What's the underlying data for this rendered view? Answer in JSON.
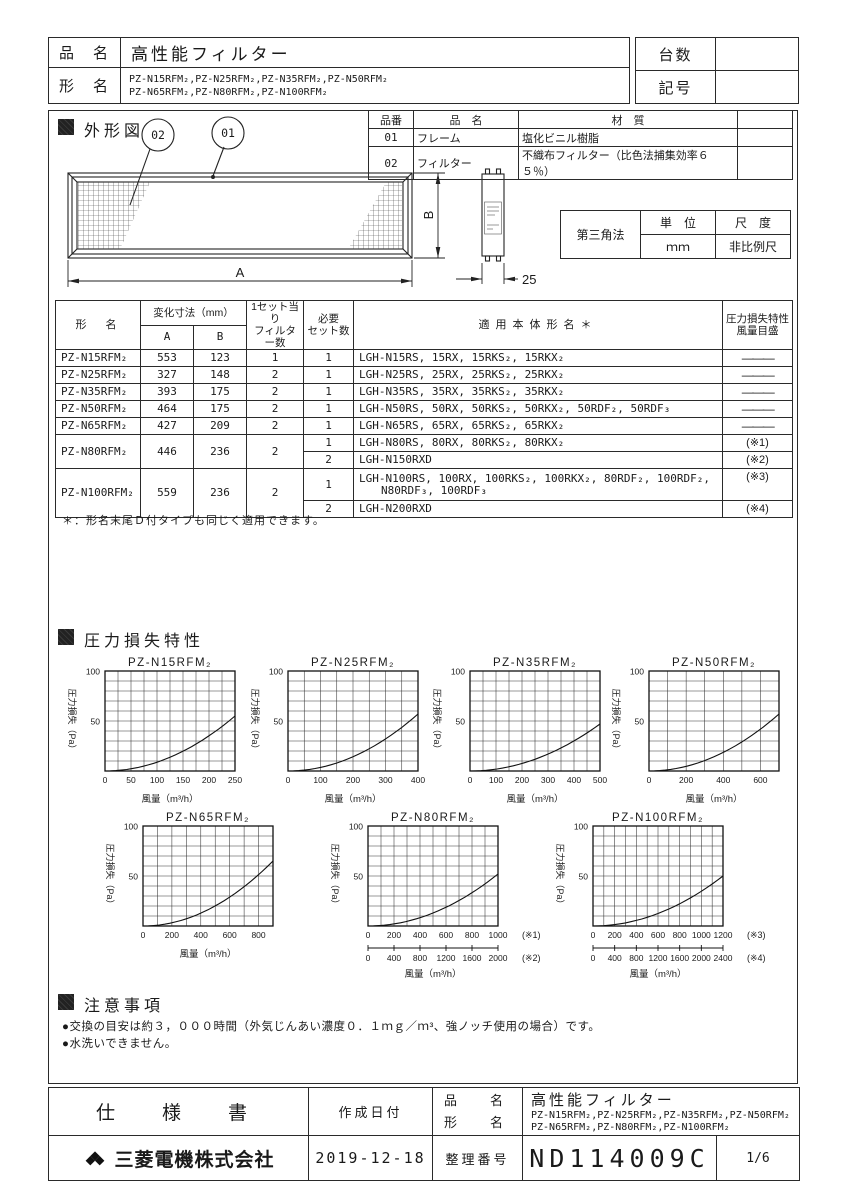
{
  "header": {
    "hinmei_label": "品　名",
    "hinmei_value": "高性能フィルター",
    "katamei_label": "形　名",
    "katamei_line1": "PZ-N15RFM₂,PZ-N25RFM₂,PZ-N35RFM₂,PZ-N50RFM₂",
    "katamei_line2": "PZ-N65RFM₂,PZ-N80RFM₂,PZ-N100RFM₂",
    "daisu_label": "台数",
    "kigo_label": "記号"
  },
  "outline": {
    "section_title": "外形図",
    "balloon_02": "02",
    "balloon_01": "01",
    "dim_a": "A",
    "dim_b": "B",
    "dim_side": "25"
  },
  "parts_table": {
    "h_no": "品番",
    "h_name": "品　名",
    "h_material": "材　質",
    "rows": [
      {
        "no": "01",
        "name": "フレーム",
        "material": "塩化ビニル樹脂"
      },
      {
        "no": "02",
        "name": "フィルター",
        "material": "不織布フィルター（比色法捕集効率６５％）"
      }
    ]
  },
  "projection": {
    "method": "第三角法",
    "unit_label": "単　位",
    "unit_value": "ｍｍ",
    "scale_label": "尺　度",
    "scale_value": "非比例尺"
  },
  "spec_table": {
    "h_model": "形　名",
    "h_dims": "変化寸法（mm）",
    "h_a": "A",
    "h_b": "B",
    "h_filters": "1セット当り\nフィルター数",
    "h_sets": "必要\nセット数",
    "h_models": "適用本体形名＊",
    "h_scale": "圧力損失特性\n風量目盛",
    "rows_simple": [
      {
        "model": "PZ-N15RFM₂",
        "a": "553",
        "b": "123",
        "filters": "1",
        "sets": "1",
        "applicable": "LGH-N15RS, 15RX, 15RKS₂, 15RKX₂",
        "note": "———"
      },
      {
        "model": "PZ-N25RFM₂",
        "a": "327",
        "b": "148",
        "filters": "2",
        "sets": "1",
        "applicable": "LGH-N25RS, 25RX, 25RKS₂, 25RKX₂",
        "note": "———"
      },
      {
        "model": "PZ-N35RFM₂",
        "a": "393",
        "b": "175",
        "filters": "2",
        "sets": "1",
        "applicable": "LGH-N35RS, 35RX, 35RKS₂, 35RKX₂",
        "note": "———"
      },
      {
        "model": "PZ-N50RFM₂",
        "a": "464",
        "b": "175",
        "filters": "2",
        "sets": "1",
        "applicable": "LGH-N50RS, 50RX, 50RKS₂, 50RKX₂, 50RDF₂, 50RDF₃",
        "note": "———"
      },
      {
        "model": "PZ-N65RFM₂",
        "a": "427",
        "b": "209",
        "filters": "2",
        "sets": "1",
        "applicable": "LGH-N65RS, 65RX, 65RKS₂, 65RKX₂",
        "note": "———"
      }
    ],
    "row_n80": {
      "model": "PZ-N80RFM₂",
      "a": "446",
      "b": "236",
      "filters": "2",
      "set1": {
        "sets": "1",
        "applicable": "LGH-N80RS, 80RX, 80RKS₂, 80RKX₂",
        "note": "(※1)"
      },
      "set2": {
        "sets": "2",
        "applicable": "LGH-N150RXD",
        "note": "(※2)"
      }
    },
    "row_n100": {
      "model": "PZ-N100RFM₂",
      "a": "559",
      "b": "236",
      "filters": "2",
      "set1": {
        "sets": "1",
        "applicable": "LGH-N100RS, 100RX, 100RKS₂, 100RKX₂, 80RDF₂, 100RDF₂,\n　　N80RDF₃, 100RDF₃",
        "note": "(※3)"
      },
      "set2": {
        "sets": "2",
        "applicable": "LGH-N200RXD",
        "note": "(※4)"
      }
    },
    "footnote": "＊：形名末尾Ｄ付タイプも同じく適用できます。"
  },
  "charts_section_title": "圧力損失特性",
  "chart_data": [
    {
      "type": "line",
      "title": "PZ-N15RFM₂",
      "xlabel": "風量（m³/h）",
      "ylabel": "圧力損失（Pa）",
      "xlim": [
        0,
        250
      ],
      "ylim": [
        0,
        100
      ],
      "x_ticks": [
        0,
        50,
        100,
        150,
        200,
        250
      ],
      "x_grid_step": 25,
      "y_ticks": [
        50,
        100
      ],
      "y_grid_step": 10,
      "curve": "quadratic from origin",
      "curve_end_pa": 55
    },
    {
      "type": "line",
      "title": "PZ-N25RFM₂",
      "xlabel": "風量（m³/h）",
      "ylabel": "圧力損失（Pa）",
      "xlim": [
        0,
        400
      ],
      "ylim": [
        0,
        100
      ],
      "x_ticks": [
        0,
        100,
        200,
        300,
        400
      ],
      "x_grid_step": 50,
      "y_ticks": [
        50,
        100
      ],
      "y_grid_step": 10,
      "curve": "quadratic from origin",
      "curve_end_pa": 57
    },
    {
      "type": "line",
      "title": "PZ-N35RFM₂",
      "xlabel": "風量（m³/h）",
      "ylabel": "圧力損失（Pa）",
      "xlim": [
        0,
        500
      ],
      "ylim": [
        0,
        100
      ],
      "x_ticks": [
        0,
        100,
        200,
        300,
        400,
        500
      ],
      "x_grid_step": 50,
      "y_ticks": [
        50,
        100
      ],
      "y_grid_step": 10,
      "curve": "quadratic from origin",
      "curve_end_pa": 47
    },
    {
      "type": "line",
      "title": "PZ-N50RFM₂",
      "xlabel": "風量（m³/h）",
      "ylabel": "圧力損失（Pa）",
      "xlim": [
        0,
        700
      ],
      "ylim": [
        0,
        100
      ],
      "x_ticks": [
        0,
        200,
        400,
        600
      ],
      "x_grid_step": 100,
      "y_ticks": [
        50,
        100
      ],
      "y_grid_step": 10,
      "curve": "quadratic from origin",
      "curve_end_pa": 57
    },
    {
      "type": "line",
      "title": "PZ-N65RFM₂",
      "xlabel": "風量（m³/h）",
      "ylabel": "圧力損失（Pa）",
      "xlim": [
        0,
        900
      ],
      "ylim": [
        0,
        100
      ],
      "x_ticks": [
        0,
        200,
        400,
        600,
        800
      ],
      "x_grid_step": 100,
      "y_ticks": [
        50,
        100
      ],
      "y_grid_step": 10,
      "curve": "quadratic from origin",
      "curve_end_pa": 65
    },
    {
      "type": "line",
      "title": "PZ-N80RFM₂",
      "xlabel": "風量（m³/h）",
      "ylabel": "圧力損失（Pa）",
      "xlim": [
        0,
        1000
      ],
      "ylim": [
        0,
        100
      ],
      "x_ticks": [
        0,
        200,
        400,
        600,
        800,
        1000
      ],
      "x_grid_step": 100,
      "y_ticks": [
        50,
        100
      ],
      "y_grid_step": 10,
      "axis1_note": "(※1)",
      "x_ticks2": [
        0,
        400,
        800,
        1200,
        1600,
        2000
      ],
      "axis2_note": "(※2)",
      "curve": "quadratic from origin",
      "curve_end_pa": 52
    },
    {
      "type": "line",
      "title": "PZ-N100RFM₂",
      "xlabel": "風量（m³/h）",
      "ylabel": "圧力損失（Pa）",
      "xlim": [
        0,
        1200
      ],
      "ylim": [
        0,
        100
      ],
      "x_ticks": [
        0,
        200,
        400,
        600,
        800,
        1000,
        1200
      ],
      "x_grid_step": 100,
      "y_ticks": [
        50,
        100
      ],
      "y_grid_step": 10,
      "axis1_note": "(※3)",
      "x_ticks2": [
        0,
        400,
        800,
        1200,
        1600,
        2000,
        2400
      ],
      "axis2_note": "(※4)",
      "curve": "quadratic from origin",
      "curve_end_pa": 50
    }
  ],
  "notes": {
    "title": "注意事項",
    "items": [
      "●交換の目安は約３，０００時間（外気じんあい濃度０．１ｍｇ／ｍ³、強ノッチ使用の場合）です。",
      "●水洗いできません。"
    ]
  },
  "footer": {
    "spec_label": "仕　様　書",
    "date_label": "作成日付",
    "date_value": "2019-12-18",
    "hinmei_label": "品　名",
    "katamei_label": "形　名",
    "product_title": "高性能フィルター",
    "models_line1": "PZ-N15RFM₂,PZ-N25RFM₂,PZ-N35RFM₂,PZ-N50RFM₂",
    "models_line2": "PZ-N65RFM₂,PZ-N80RFM₂,PZ-N100RFM₂",
    "company": "三菱電機株式会社",
    "doc_label": "整理番号",
    "doc_number": "ND114009C",
    "page": "1/6"
  },
  "colors": {
    "ink": "#1a1a1a",
    "line": "#2a2a2a",
    "paper": "#ffffff"
  }
}
